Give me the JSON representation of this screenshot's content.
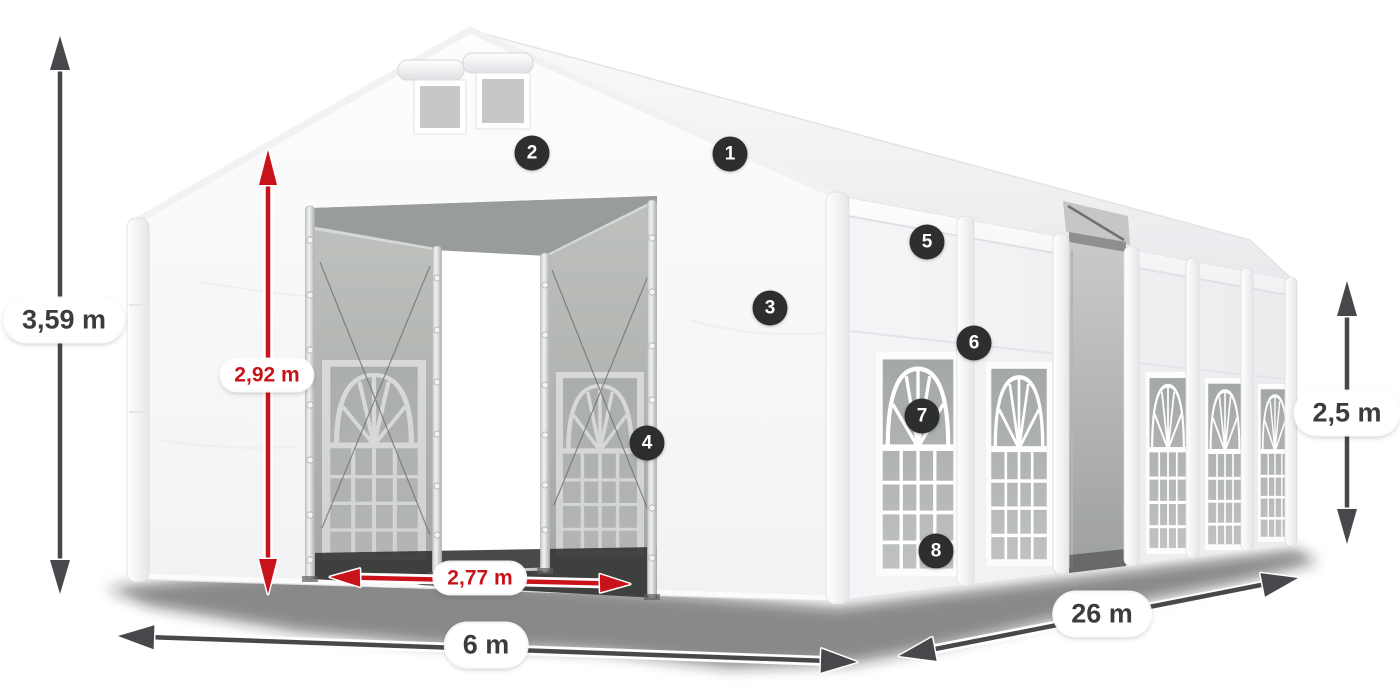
{
  "figure": {
    "type": "product-dimension-diagram",
    "subject": "white marquee tent with open entrances"
  },
  "colors": {
    "bg": "#ffffff",
    "arrow_dark": "#47484b",
    "arrow_red": "#c9131a",
    "badge_bg": "#2d2e30",
    "badge_text": "#ffffff",
    "pill_bg": "#ffffff",
    "pill_text_dark": "#3b3c3e",
    "pill_text_red": "#c9131a"
  },
  "dimensions": [
    {
      "id": "total-height",
      "label": "3,59 m",
      "style": "dark"
    },
    {
      "id": "entrance-height",
      "label": "2,92 m",
      "style": "red"
    },
    {
      "id": "entrance-width",
      "label": "2,77 m",
      "style": "red"
    },
    {
      "id": "width",
      "label": "6 m",
      "style": "dark"
    },
    {
      "id": "length",
      "label": "26 m",
      "style": "dark"
    },
    {
      "id": "side-height",
      "label": "2,5 m",
      "style": "dark"
    }
  ],
  "callouts": [
    {
      "number": "1"
    },
    {
      "number": "2"
    },
    {
      "number": "3"
    },
    {
      "number": "4"
    },
    {
      "number": "5"
    },
    {
      "number": "6"
    },
    {
      "number": "7"
    },
    {
      "number": "8"
    }
  ]
}
